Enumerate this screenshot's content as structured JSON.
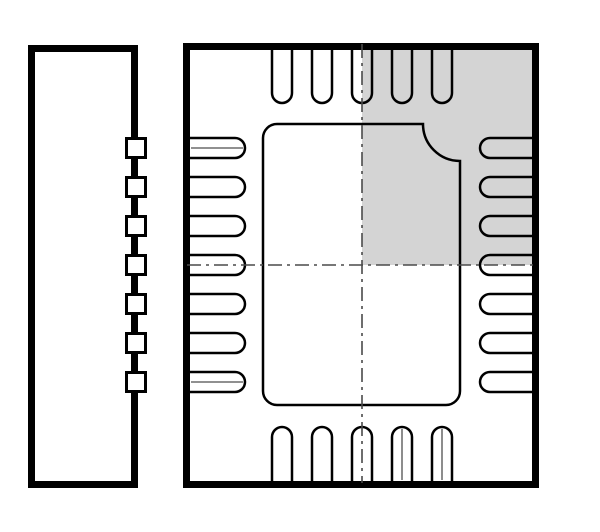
{
  "figure": {
    "kind": "ic-package-outline-drawing",
    "package_style": "QFN-24",
    "views": {
      "side_view_label": "side-view",
      "top_view_label": "top-view"
    }
  },
  "drawing": {
    "canvas": {
      "width": 600,
      "height": 532,
      "background": "#ffffff"
    },
    "colors": {
      "line": "#000000",
      "fill_none": "none",
      "white": "#ffffff",
      "shade": "#d4d4d4",
      "centerline": "#4a4a4a",
      "midline": "#808080"
    },
    "side_view": {
      "rect": {
        "x": 31.5,
        "y": 48.5,
        "w": 103,
        "h": 436,
        "stroke_w": 7
      },
      "bumps": {
        "count": 7,
        "cx": 136,
        "size": 19,
        "stroke_w": 3,
        "centers_y": [
          148,
          187,
          226,
          265,
          304,
          343,
          382
        ]
      }
    },
    "top_view": {
      "rect": {
        "x": 186.5,
        "y": 46.5,
        "w": 349,
        "h": 438,
        "stroke_w": 7
      },
      "shade_rect": {
        "x": 362,
        "y": 47,
        "w": 172,
        "h": 218
      },
      "pads": {
        "stroke_w": 2.5,
        "half_w": 10,
        "radius": 10,
        "top": {
          "count": 5,
          "centers_x": [
            282,
            322,
            362,
            402,
            442
          ],
          "edge_y": 48,
          "flat_y": 93
        },
        "bottom": {
          "count": 5,
          "centers_x": [
            282,
            322,
            362,
            402,
            442
          ],
          "edge_y": 483,
          "flat_y": 437
        },
        "left": {
          "count": 7,
          "centers_y": [
            148,
            187,
            226,
            265,
            304,
            343,
            382
          ],
          "edge_x": 188,
          "flat_x": 235
        },
        "right": {
          "count": 7,
          "centers_y": [
            148,
            187,
            226,
            265,
            304,
            343,
            382
          ],
          "edge_x": 534,
          "flat_x": 490
        }
      },
      "exposed_pad": {
        "path": "M 277,124 H 423 A 37 37 0 0 0 460,161 V 391 A 14 14 0 0 1 446,405 H 277 A 14 14 0 0 1 263,391 V 138 A 14 14 0 0 1 277,124 Z",
        "stroke_w": 2.5
      },
      "pad_midlines": {
        "stroke_w": 1.8,
        "lines": [
          {
            "x1": 191,
            "y1": 148,
            "x2": 243,
            "y2": 148
          },
          {
            "x1": 191,
            "y1": 382,
            "x2": 243,
            "y2": 382
          },
          {
            "x1": 402,
            "y1": 429,
            "x2": 402,
            "y2": 480
          },
          {
            "x1": 442,
            "y1": 429,
            "x2": 442,
            "y2": 480
          }
        ]
      },
      "centerlines": {
        "stroke_w": 1.6,
        "dash": "14 5 3 5",
        "vertical": {
          "x": 362,
          "y1": 44,
          "y2": 483
        },
        "horizontal": {
          "y": 265,
          "x1": 187,
          "x2": 534
        }
      }
    }
  }
}
